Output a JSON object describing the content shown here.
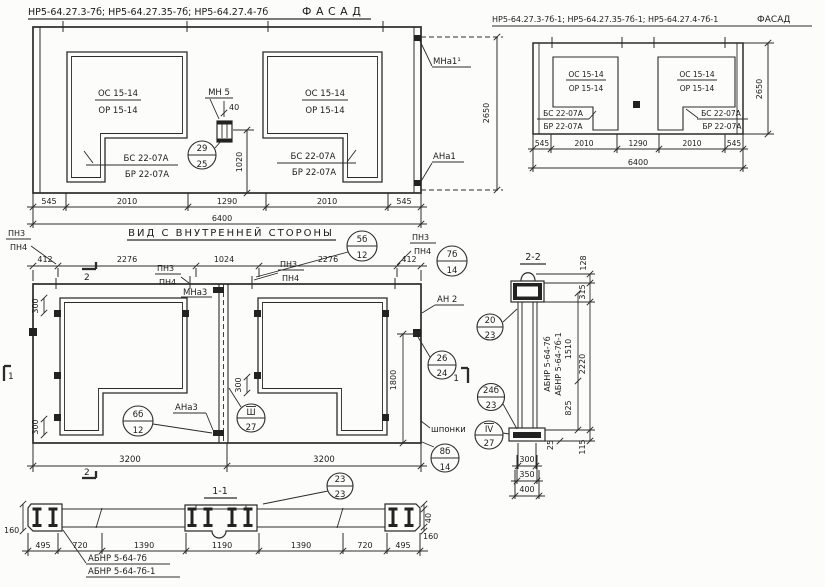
{
  "facade_main": {
    "title": "НР5-64.27.3-7б; НР5-64.27.35-7б; НР5-64.27.4-7б",
    "view_label": "ФАСАД",
    "win_left": {
      "oc": "ОС 15-14",
      "op": "ОР 15-14",
      "bc": "БС 22-07А",
      "bp": "БР 22-07А"
    },
    "win_right": {
      "oc": "ОС 15-14",
      "op": "ОР 15-14",
      "bc": "БС 22-07А",
      "bp": "БР 22-07А"
    },
    "mn5": "МН 5",
    "dim40": "40",
    "callout_29": {
      "num": "29",
      "sheet": "25"
    },
    "dim1020": "1020",
    "mna1": "МНа1¹",
    "ana1": "АНа1",
    "dim2650": "2650",
    "dims_bottom": [
      "545",
      "2010",
      "1290",
      "2010",
      "545"
    ],
    "dim_total": "6400"
  },
  "facade_mirror": {
    "title": "НР5-64.27.3-7б-1; НР5-64.27.35-7б-1; НР5-64.27.4-7б-1",
    "view_label": "ФАСАД",
    "win_left": {
      "oc": "ОС 15-14",
      "op": "ОР 15-14",
      "bc": "БС 22-07А",
      "bp": "БР 22-07А"
    },
    "win_right": {
      "oc": "ОС 15-14",
      "op": "ОР 15-14",
      "bc": "БС 22-07А",
      "bp": "БР 22-07А"
    },
    "dims_bottom": [
      "545",
      "2010",
      "1290",
      "2010",
      "545"
    ],
    "dim_total": "6400",
    "dim2650": "2650"
  },
  "inner_view": {
    "title": "ВИД С ВНУТРЕННЕЙ СТОРОНЫ",
    "pn3": "ПН3",
    "pn4": "ПН4",
    "dims_top": [
      "412",
      "2276",
      "1024",
      "2276",
      "412"
    ],
    "callout_5b": {
      "num": "5б",
      "sheet": "12"
    },
    "callout_7b": {
      "num": "7б",
      "sheet": "14"
    },
    "mna3": "МНа3",
    "ana3": "АНа3",
    "callout_6b": {
      "num": "6б",
      "sheet": "12"
    },
    "callout_sh": {
      "num": "Ш",
      "sheet": "27"
    },
    "an2": "АН 2",
    "callout_26": {
      "num": "26",
      "sheet": "24"
    },
    "dim1800": "1800",
    "shponki": "шпонки",
    "callout_8b": {
      "num": "8б",
      "sheet": "14"
    },
    "dim300": "300",
    "dims_bottom": [
      "3200",
      "3200"
    ],
    "marker1": "1",
    "marker2": "2"
  },
  "section22": {
    "title": "2-2",
    "callout_20": {
      "num": "20",
      "sheet": "23"
    },
    "callout_24b": {
      "num": "24б",
      "sheet": "23"
    },
    "callout_iv": {
      "num": "IV",
      "sheet": "27"
    },
    "label_abnr": "АБНР 5-64-7б",
    "label_abnr1": "АБНР 5-64-7б-1",
    "dim1510": "1510",
    "dims": {
      "d128": "128",
      "d315": "315",
      "d2220": "2220",
      "d825": "825",
      "d25": "25",
      "d115": "115",
      "d300": "300",
      "d350": "350",
      "d400": "400"
    }
  },
  "section11": {
    "title": "1-1",
    "callout_23": {
      "num": "23",
      "sheet": "23"
    },
    "dims_bottom": [
      "495",
      "720",
      "1390",
      "1190",
      "1390",
      "720",
      "495"
    ],
    "dim160_left": "160",
    "dim40": "40",
    "dim160_right": "160",
    "label_abnr": "АБНР 5-64-7б",
    "label_abnr1": "АБНР 5-64-7б-1",
    "marker2": "2"
  }
}
